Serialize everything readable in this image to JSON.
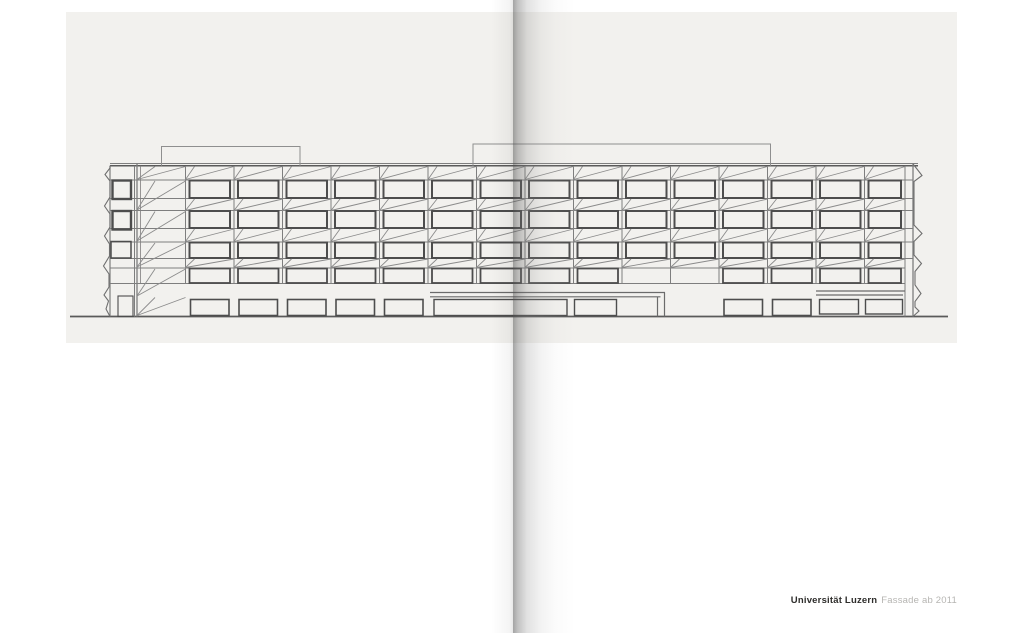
{
  "page": {
    "width": 1024,
    "height": 633,
    "background": "#ffffff"
  },
  "caption": {
    "title": "Universität Luzern",
    "subtitle": "Fassade ab 2011",
    "title_color": "#2e2d2b",
    "subtitle_color": "#b6b5b2",
    "right_px": 67,
    "top_px": 595
  },
  "scan": {
    "panel": {
      "x": 66,
      "y": 12,
      "w": 891,
      "h": 331,
      "color": "#f2f1ee"
    },
    "gutter": {
      "fold_x": 513,
      "right_fade_w": 62,
      "left_fade_w": 22
    }
  },
  "figure": {
    "type": "architectural-elevation-line-drawing",
    "subject": "University of Lucerne facade elevation, five storeys with diagonal folded-plate spandrels",
    "colors": {
      "thin": "#7e7e7e",
      "diag": "#8b8b8b",
      "window": "#4d4d4d",
      "dark": "#5a5a5a"
    },
    "bays": [
      137,
      185.5,
      234,
      282.5,
      331,
      379.5,
      428,
      476.5,
      525,
      573.5,
      622,
      670.5,
      719,
      767.5,
      816,
      864.5,
      905
    ],
    "mullionTop": 166,
    "mullionBot": 283.5,
    "roofY": 165.8,
    "shortDiagDx": 9,
    "wideShortDx": 18,
    "horizontals": [
      {
        "x1": 110,
        "x2": 918,
        "y": 163.5,
        "w": 1
      },
      {
        "x1": 110,
        "x2": 918,
        "y": 165.8,
        "w": 1.5,
        "c": "#5a5a5a"
      },
      {
        "x1": 110,
        "x2": 913,
        "y": 180,
        "w": 1
      },
      {
        "x1": 110,
        "x2": 913,
        "y": 198.5,
        "w": 1
      },
      {
        "x1": 110,
        "x2": 913,
        "y": 210.5,
        "w": 1
      },
      {
        "x1": 110,
        "x2": 913,
        "y": 228.5,
        "w": 1
      },
      {
        "x1": 110,
        "x2": 913,
        "y": 242,
        "w": 1
      },
      {
        "x1": 110,
        "x2": 913,
        "y": 258.5,
        "w": 1
      },
      {
        "x1": 110,
        "x2": 905,
        "y": 268,
        "w": 1
      },
      {
        "x1": 110,
        "x2": 905,
        "y": 283.5,
        "w": 1
      },
      {
        "x1": 70,
        "x2": 948,
        "y": 316.5,
        "w": 1.7,
        "c": "#5a5a5a"
      }
    ],
    "verticals": [
      {
        "x": 110,
        "y1": 165.8,
        "y2": 316.5,
        "w": 1.2
      },
      {
        "x": 134.5,
        "y1": 165.8,
        "y2": 316.5,
        "w": 1
      },
      {
        "x": 137,
        "y1": 163.5,
        "y2": 316.5,
        "w": 1.3
      },
      {
        "x": 140.5,
        "y1": 165.8,
        "y2": 283.5,
        "w": 0.8
      },
      {
        "x": 905,
        "y1": 165.8,
        "y2": 316.5,
        "w": 1
      },
      {
        "x": 913,
        "y1": 163.5,
        "y2": 316.5,
        "w": 1.3
      }
    ],
    "rows": [
      {
        "top": 180.5,
        "h": 17.5,
        "inset": 4,
        "w": 2
      },
      {
        "top": 211,
        "h": 17,
        "inset": 4,
        "w": 2
      },
      {
        "top": 242.5,
        "h": 15.5,
        "inset": 4,
        "w": 2
      },
      {
        "top": 268.5,
        "h": 14.5,
        "inset": 4,
        "w": 1.8,
        "skip": [
          10,
          11
        ]
      },
      {
        "top": 299.5,
        "h": 16,
        "inset": 5,
        "w": 1.6,
        "only": [
          1,
          2,
          3,
          4,
          5,
          12,
          13
        ]
      }
    ],
    "bands": [
      {
        "t": 166.5,
        "b": 179.5
      },
      {
        "t": 199,
        "b": 210.5
      },
      {
        "t": 229,
        "b": 241.5
      },
      {
        "t": 259,
        "b": 267.5
      }
    ],
    "wideBands": [
      {
        "t": 166.5,
        "b": 179.5
      },
      {
        "t": 181,
        "b": 210
      },
      {
        "t": 211.5,
        "b": 241
      },
      {
        "t": 243,
        "b": 267
      },
      {
        "t": 269,
        "b": 296
      },
      {
        "t": 297.5,
        "b": 315.5
      }
    ],
    "extraRects": [
      {
        "x": 112.5,
        "y": 180.5,
        "w": 18.5,
        "h": 18.5,
        "sw": 2.4
      },
      {
        "x": 112.5,
        "y": 211,
        "w": 18.5,
        "h": 18.5,
        "sw": 2.4
      },
      {
        "x": 111,
        "y": 241.5,
        "w": 20,
        "h": 16.5,
        "sw": 1.5
      },
      {
        "x": 118,
        "y": 296,
        "w": 15,
        "h": 20.5,
        "sw": 1.1
      },
      {
        "x": 434,
        "y": 299.5,
        "w": 133,
        "h": 16,
        "sw": 1.4
      },
      {
        "x": 574.5,
        "y": 299.5,
        "w": 42,
        "h": 16,
        "sw": 1.4
      },
      {
        "x": 819.5,
        "y": 299.5,
        "w": 39,
        "h": 14.5,
        "sw": 1.4
      },
      {
        "x": 865.5,
        "y": 299.5,
        "w": 37,
        "h": 14.5,
        "sw": 1.4
      }
    ],
    "paths": [
      {
        "d": "M161.5,165.8 L161.5,146.5 L300,146.5 L300,165.8",
        "w": 1,
        "c": "#8f8f8f"
      },
      {
        "d": "M473,165.8 L473,144 L770.5,144 L770.5,165.8",
        "w": 1,
        "c": "#8f8f8f"
      },
      {
        "d": "M430,292.5 H665 M430,296.8 H660.5 M657.5,296.8 V316.5 M664.5,292.5 V316.5",
        "w": 1.2,
        "c": "#6b6b6b"
      },
      {
        "d": "M816,291 H905 M816,295 H903",
        "w": 1.2,
        "c": "#6b6b6b"
      },
      {
        "d": "M110,165.8 V168 L105,174.5 L110,181 V197 L104.5,206 L110,214 V227 L104.5,236 L109.5,244 V256 L103.5,266 L109,274 V287 L104,295 L108.5,301 L106,309 L110,316.5",
        "w": 1.1,
        "c": "#6f6f6f"
      },
      {
        "d": "M913,164 L917,169 L922,175.5 L914,181.5 V225 L922,233.5 L914,241.5 V255 L921.5,263.5 L915,271.5 V285 L921,293.5 L915,301.5 V307 L919,311 L913,316.5",
        "w": 1.1,
        "c": "#6f6f6f"
      }
    ]
  }
}
